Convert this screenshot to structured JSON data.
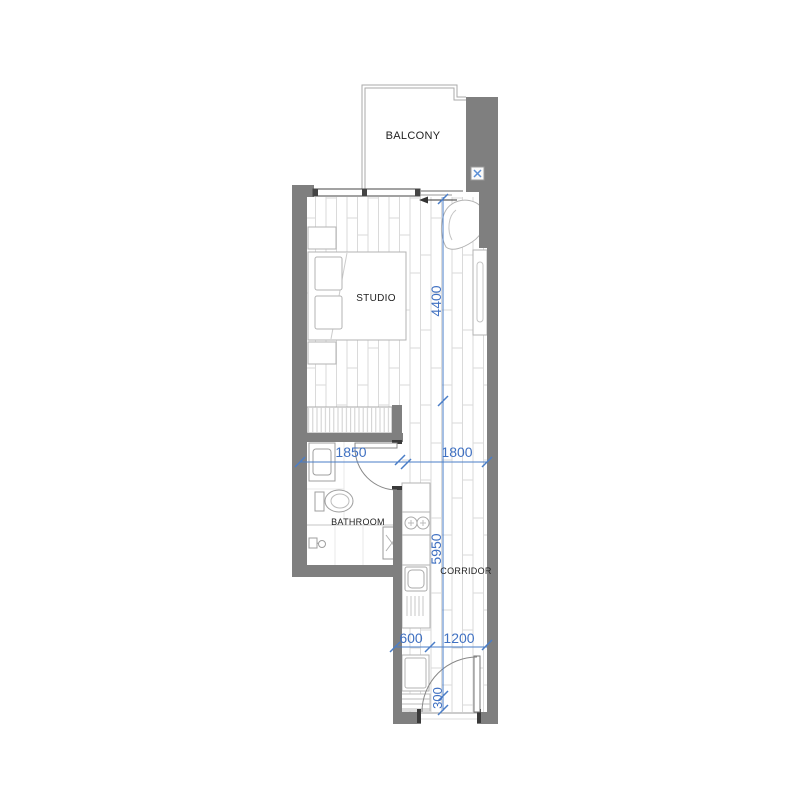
{
  "plan": {
    "title": "Studio apartment floor plan",
    "rooms": {
      "balcony": "BALCONY",
      "studio": "STUDIO",
      "bathroom": "BATHROOM",
      "corridor": "CORRIDOR"
    },
    "dimensions_mm": {
      "studio_length": "4400",
      "bathroom_width": "1850",
      "living_width": "1800",
      "corridor_length": "5950",
      "kitchen_depth": "600",
      "entry_width": "1200",
      "entry_offset": "300"
    },
    "icons": {
      "ac_unit": "ac-cross-icon",
      "shower": "shower-head-icon",
      "shaft": "x-marked-shaft"
    },
    "colors": {
      "wall": "#7f7f7f",
      "dimension_blue": "#4071c2",
      "label_text": "#1f1f1f",
      "floor_line": "#dadada",
      "furniture_line": "#b3b3b3",
      "icon_blue": "#5b8fd6"
    }
  }
}
